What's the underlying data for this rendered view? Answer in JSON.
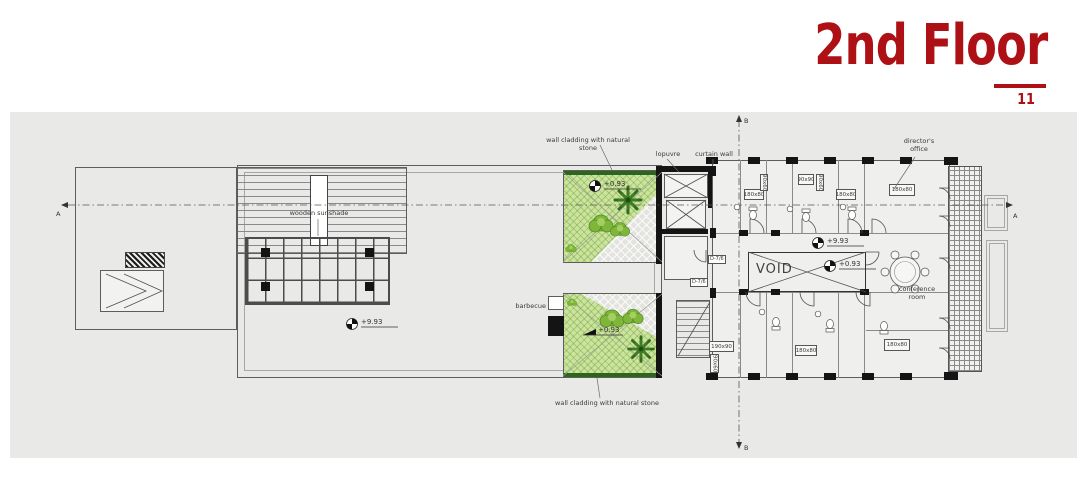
{
  "page": {
    "title": "2nd Floor",
    "page_number": "11"
  },
  "annotations": {
    "wall_cladding_top": "wall cladding with natural stone",
    "louvre": "lopuvre",
    "curtain_wall": "curtain wall",
    "wooden_sunshade": "wooden sunshade",
    "barbecue": "barbecue",
    "wall_cladding_bottom": "wall cladding with natural stone",
    "directors_office": "director's office",
    "conference_room": "conference room",
    "void_label": "VOID"
  },
  "elevations": {
    "terrace": "+9.93",
    "upper_courtyard": "+0.93",
    "lower_courtyard": "+0.93",
    "corridor": "+9.93",
    "void": "+0.93"
  },
  "fixture_dims": {
    "tub_top_left": "180x80",
    "sink_top_1": "90x60",
    "shower_top": "90x90",
    "sink_top_2": "90x60",
    "tub_top_right": "180x80",
    "desk_directors": "180x80",
    "tub_bottom_left": "190x90",
    "sink_bottom_left": "90x60",
    "tub_bottom_mid": "180x80",
    "desk_bottom_right": "180x80"
  },
  "detail_tags": {
    "tag1": "D-7/6",
    "tag2": "D-7/6"
  },
  "section_markers": {
    "left": "A",
    "right": "A",
    "top": "B",
    "bottom": "B"
  },
  "colors": {
    "title_red": "#ad1015",
    "canvas_gray": "#e9e9e7",
    "courtyard_green": "#cbe49c",
    "tree_dark": "#2f6d1d",
    "tree_light": "#7fb63a",
    "ink": "#4f4f4f"
  }
}
